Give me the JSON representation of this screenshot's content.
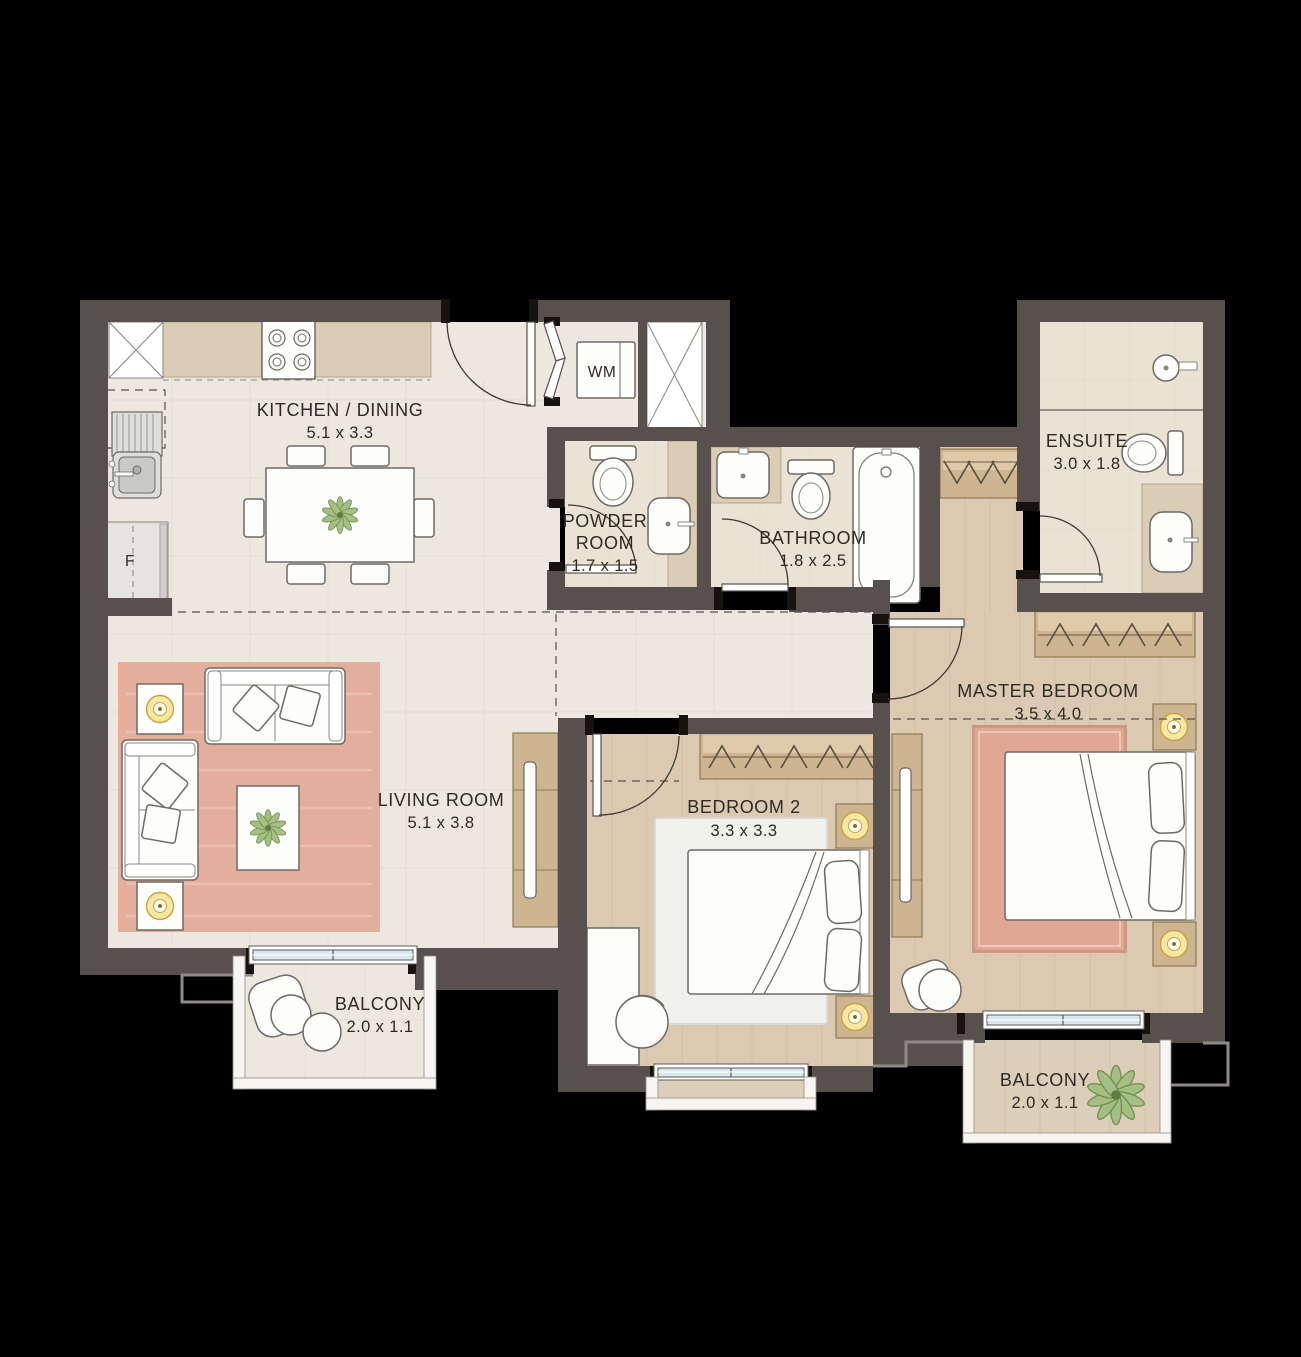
{
  "rooms": {
    "kitchen_dining": {
      "label": "KITCHEN / DINING",
      "dims": "5.1 x 3.3"
    },
    "powder_room": {
      "label_line1": "POWDER",
      "label_line2": "ROOM",
      "dims": "1.7 x 1.5"
    },
    "bathroom": {
      "label": "BATHROOM",
      "dims": "1.8 x 2.5"
    },
    "ensuite": {
      "label": "ENSUITE",
      "dims": "3.0 x 1.8"
    },
    "master_bedroom": {
      "label": "MASTER BEDROOM",
      "dims": "3.5 x 4.0"
    },
    "bedroom_2": {
      "label": "BEDROOM 2",
      "dims": "3.3 x 3.3"
    },
    "living_room": {
      "label": "LIVING ROOM",
      "dims": "5.1 x 3.8"
    },
    "balcony_left": {
      "label": "BALCONY",
      "dims": "2.0 x 1.1"
    },
    "balcony_right": {
      "label": "BALCONY",
      "dims": "2.0 x 1.1"
    }
  },
  "appliances": {
    "washing_machine": "WM",
    "dishwasher": "DW",
    "fridge": "F"
  },
  "colors": {
    "background": "#000000",
    "wall": "#57504D",
    "floor_tile": "#EDE8DF",
    "floor_bath": "#EAE3D5",
    "floor_wood": "#DCC9B1",
    "rug_pink": "#E4AE9D",
    "rug_light": "#F0F1EE",
    "wood_furniture": "#CDB592",
    "lamp_yellow": "#F6E8A4",
    "window_glass": "#D9E7EE",
    "plant_green": "#A5BE83",
    "label_text": "#2E2A25"
  }
}
